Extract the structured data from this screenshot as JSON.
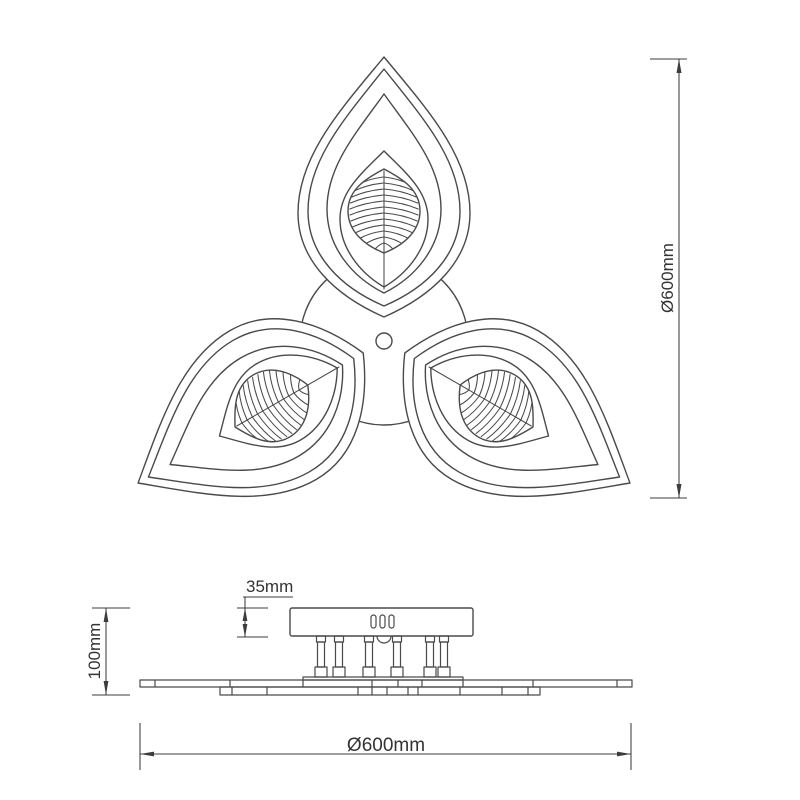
{
  "dimensions": {
    "vertical_diameter": "Ø600mm",
    "horizontal_diameter": "Ø600mm",
    "fixture_height": "100mm",
    "canopy_height": "35mm"
  },
  "colors": {
    "background": "#ffffff",
    "line": "#4a4a4a",
    "dimension_line": "#3c3c3c",
    "text": "#333333"
  }
}
